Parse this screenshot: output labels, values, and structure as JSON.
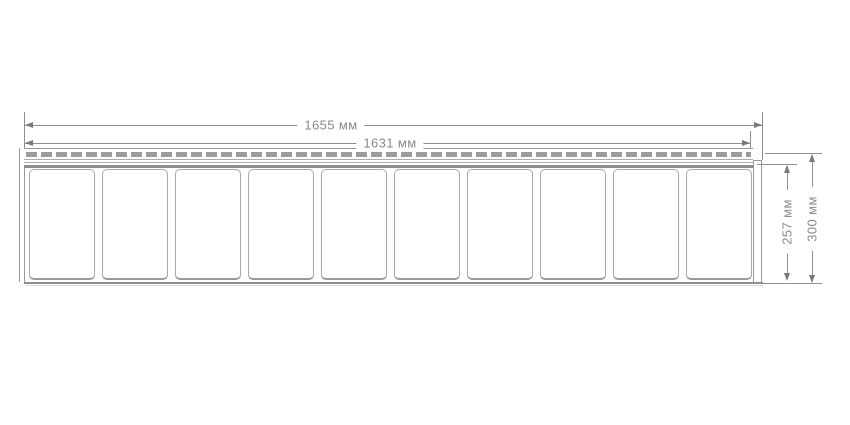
{
  "diagram": {
    "dimensions": {
      "overall_width": {
        "label": "1655 мм",
        "value": 1655,
        "unit": "мм"
      },
      "visible_width": {
        "label": "1631 мм",
        "value": 1631,
        "unit": "мм"
      },
      "face_height": {
        "label": "257 мм",
        "value": 257,
        "unit": "мм"
      },
      "overall_height": {
        "label": "300 мм",
        "value": 300,
        "unit": "мм"
      }
    },
    "panel": {
      "tile_count": 10
    },
    "colors": {
      "line": "#8f8f8f",
      "text": "#8a8a8a",
      "slot_fill": "#9c9c9c",
      "tile_border": "#a8a8a8",
      "background": "#ffffff"
    }
  }
}
